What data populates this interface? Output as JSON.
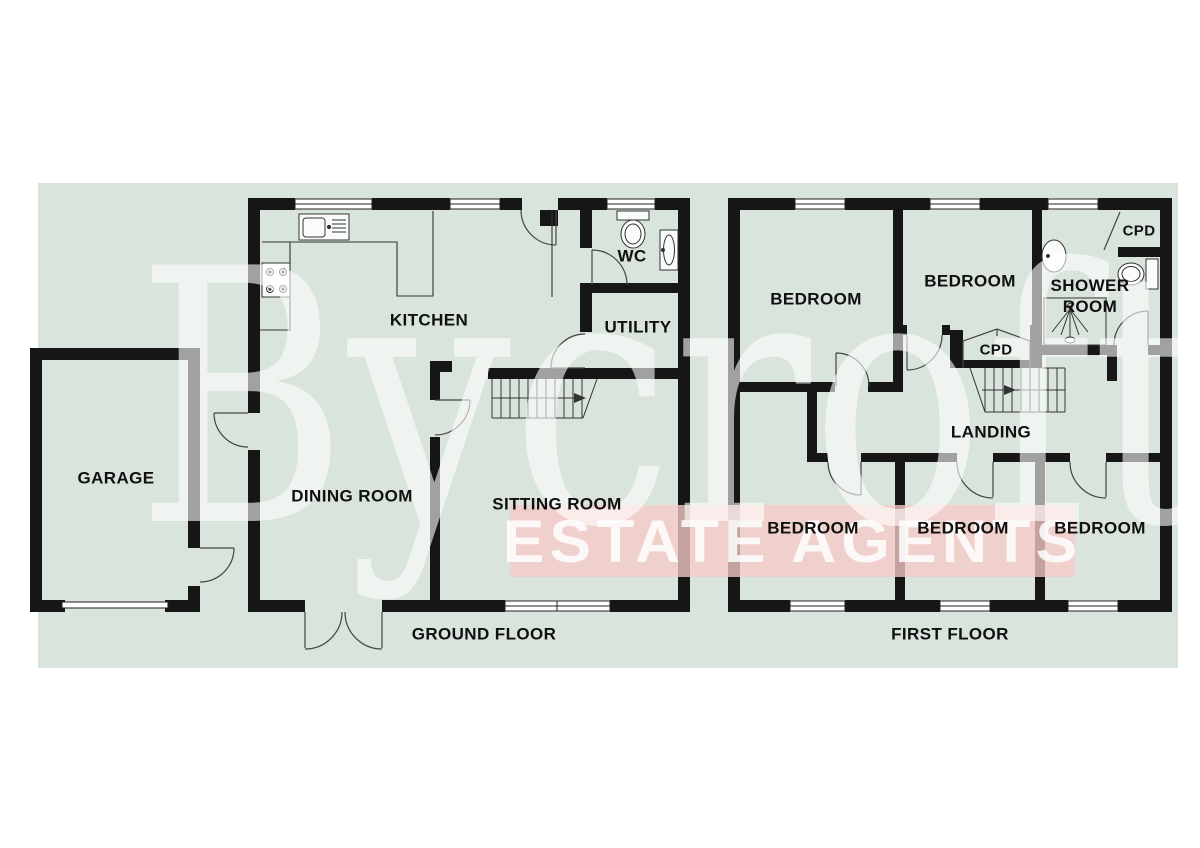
{
  "watermark": {
    "brand": "Bycroft",
    "tagline": "ESTATE AGENTS",
    "band_color": "#f6cac8",
    "text_color": "#ffffff"
  },
  "colors": {
    "canvas_background": "#d9e4dc",
    "wall": "#161616",
    "thin_line": "#333333",
    "window_fill": "#ffffff"
  },
  "floors": {
    "ground": {
      "title": "GROUND FLOOR"
    },
    "first": {
      "title": "FIRST FLOOR"
    }
  },
  "labels": {
    "garage": "GARAGE",
    "kitchen": "KITCHEN",
    "wc": "WC",
    "utility": "UTILITY",
    "dining": "DINING ROOM",
    "sitting": "SITTING ROOM",
    "ground_floor": "GROUND FLOOR",
    "bedroom_top_left": "BEDROOM",
    "bedroom_top_middle": "BEDROOM",
    "shower_line1": "SHOWER",
    "shower_line2": "ROOM",
    "cpd_top": "CPD",
    "cpd_landing": "CPD",
    "landing": "LANDING",
    "bedroom_bottom_left": "BEDROOM",
    "bedroom_bottom_middle": "BEDROOM",
    "bedroom_bottom_right": "BEDROOM",
    "first_floor": "FIRST FLOOR"
  }
}
